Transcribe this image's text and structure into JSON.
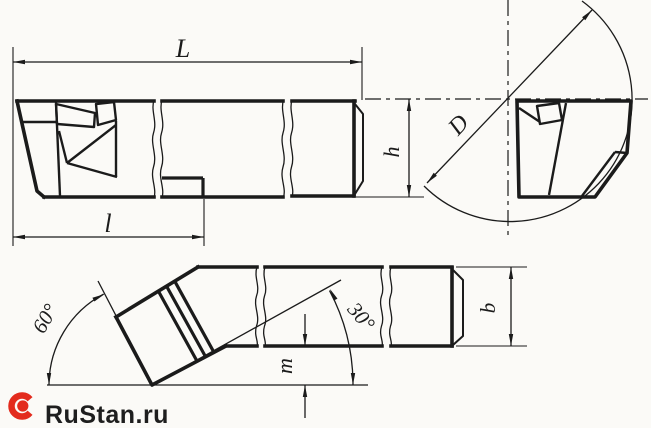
{
  "dimension_labels": {
    "total_length": "L",
    "head_length": "l",
    "shank_height": "h",
    "bore_diameter": "D",
    "tip_drop": "m",
    "shank_width": "b",
    "head_angle": "60°",
    "aux_angle": "30°"
  },
  "colors": {
    "ink": "#1b1b1b",
    "background": "#fbfaf7",
    "logo_red": "#e32b1d"
  },
  "watermark": {
    "text": "RuStan.ru"
  }
}
